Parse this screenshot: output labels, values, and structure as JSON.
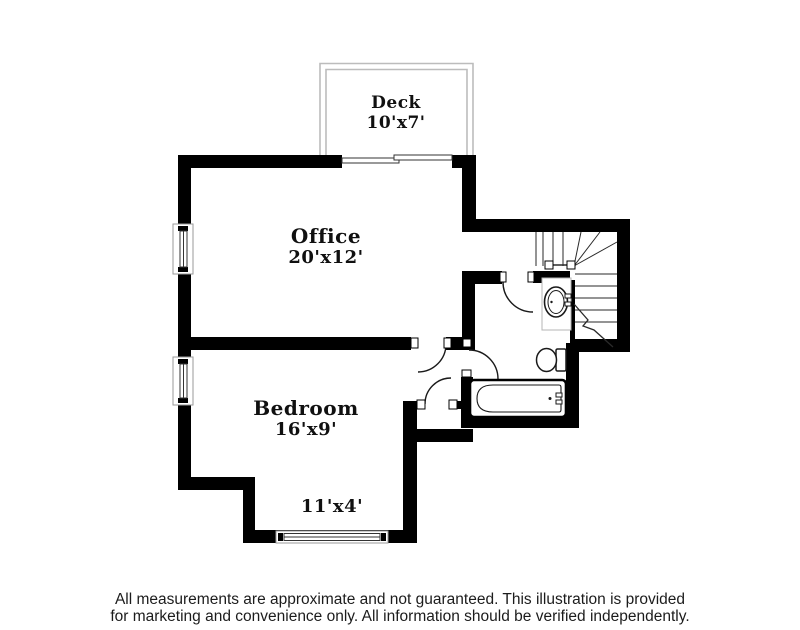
{
  "title": "Floor plan illustration",
  "rooms": [
    {
      "name": "Deck",
      "dims": "10'x7'"
    },
    {
      "name": "Office",
      "dims": "20'x12'"
    },
    {
      "name": "Bedroom",
      "dims": "16'x9'"
    },
    {
      "name": "Nook",
      "dims": "11'x4'"
    }
  ],
  "fixtures": [
    "stairs",
    "bathtub",
    "toilet",
    "sink",
    "vanity"
  ],
  "disclaimer": {
    "line1": "All measurements are approximate and not guaranteed. This illustration is provided",
    "line2": "for marketing and convenience only. All information should be verified independently."
  },
  "colors": {
    "wall": "#000000",
    "thin_line": "#2a2a2a",
    "deck_line": "#bcbcbc",
    "vanity_line": "#b5b5b5",
    "label_text": "#101010",
    "disclaimer_text": "#1c1c1c",
    "background": "#ffffff"
  }
}
